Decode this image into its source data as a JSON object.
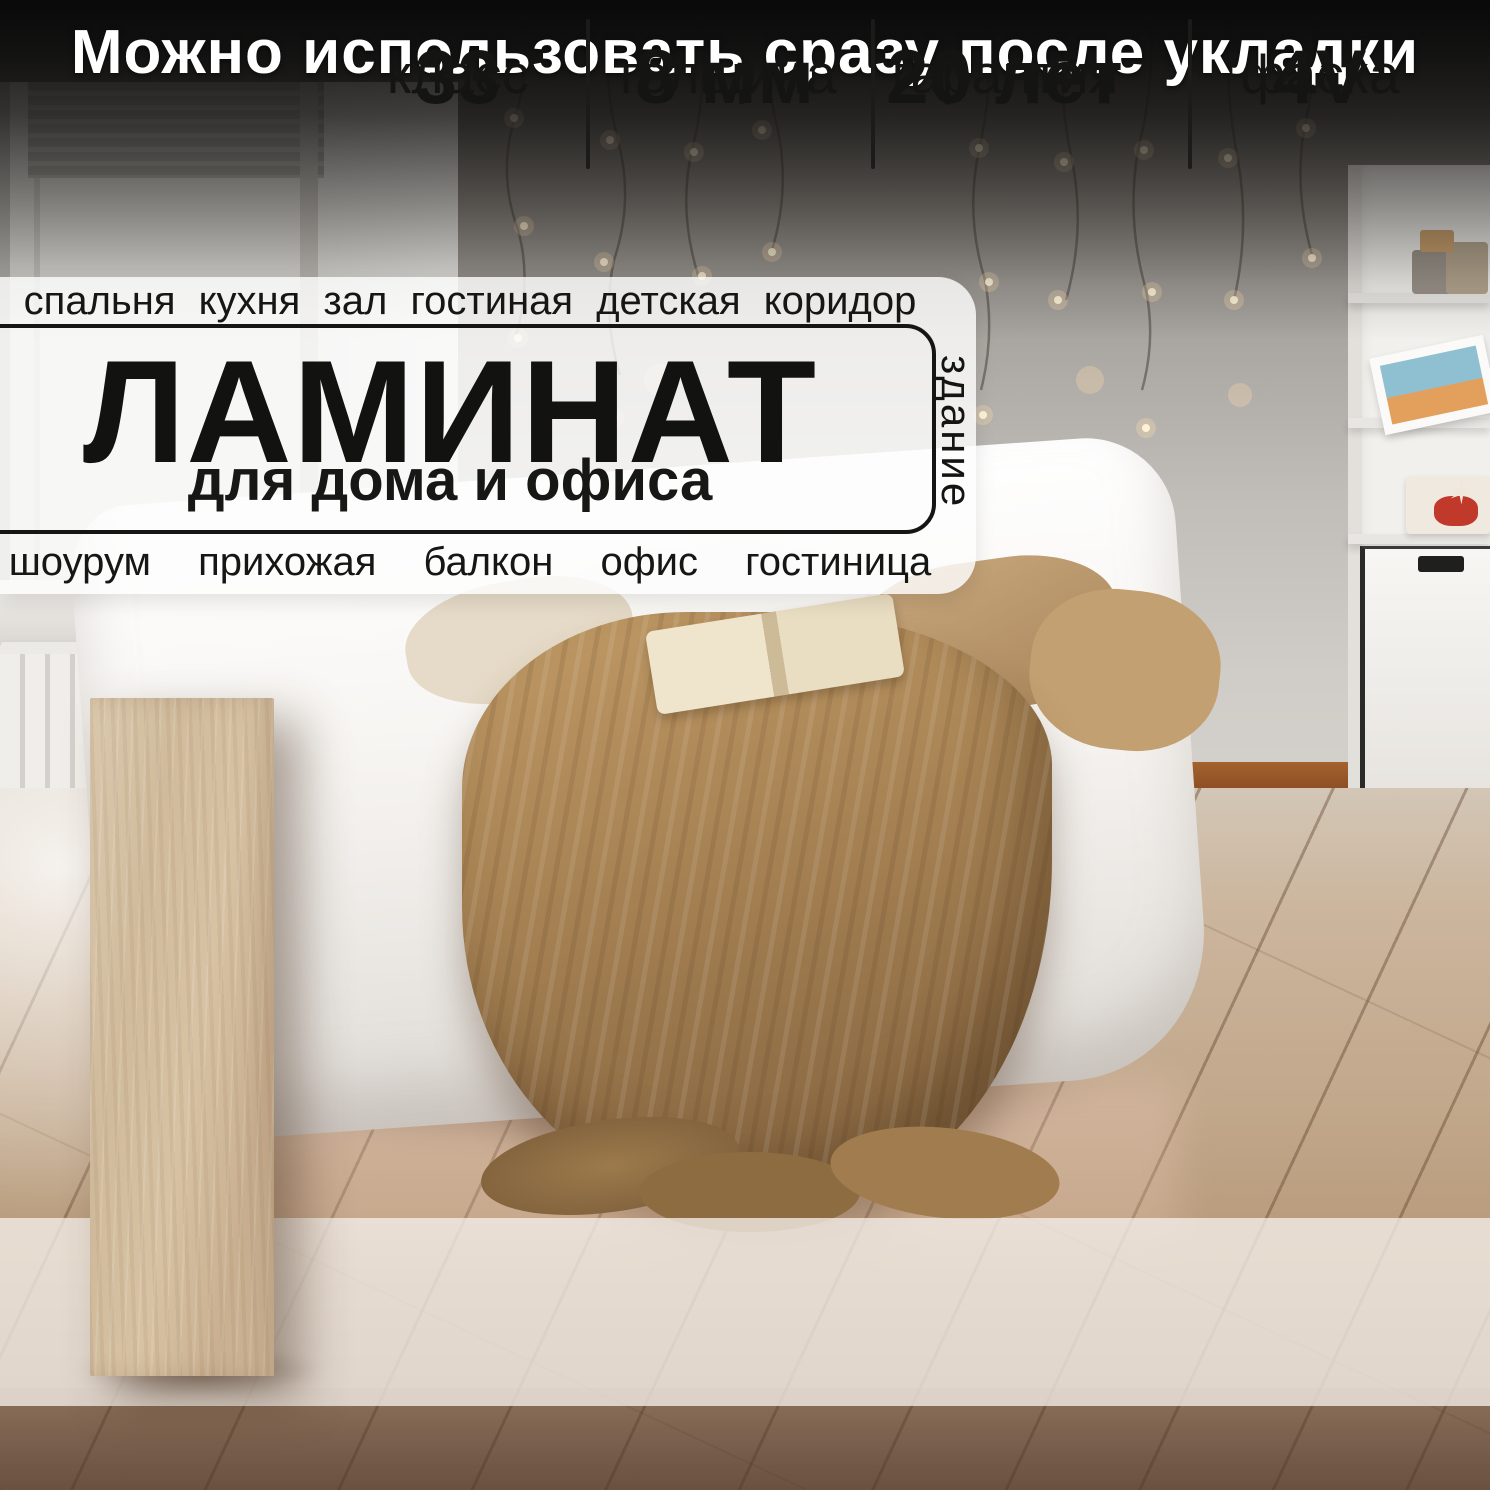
{
  "banner": {
    "text": "Можно использовать сразу после укладки"
  },
  "info_box": {
    "top_row": "спальня кухня зал гостиная детская коридор",
    "title": "ЛАМИНАТ",
    "subtitle": "для дома и офиса",
    "side_label": "здание",
    "bottom_row": "шоурум прихожая балкон офис гостиница"
  },
  "badges": [
    {
      "value": "33",
      "label": "класс"
    },
    {
      "value": "8 мм",
      "label": "толщина"
    },
    {
      "value": "20 лет",
      "label": "гарантия"
    },
    {
      "value": "4V",
      "label": "фаска"
    }
  ],
  "scene": {
    "star_glyph": "✶"
  },
  "colors": {
    "banner_text": "#ffffff",
    "headline_text": "#141412",
    "info_box_bg": "#fdfdfc",
    "badge_band_bg": "#f3eee9",
    "badge_text": "#141412",
    "floor_wood": "#c2a88c",
    "plank_wood": "#d2bd9e",
    "throw_knit": "#a9855a",
    "baseboard": "#9a5a33",
    "fairy_light": "#ffedc9"
  }
}
